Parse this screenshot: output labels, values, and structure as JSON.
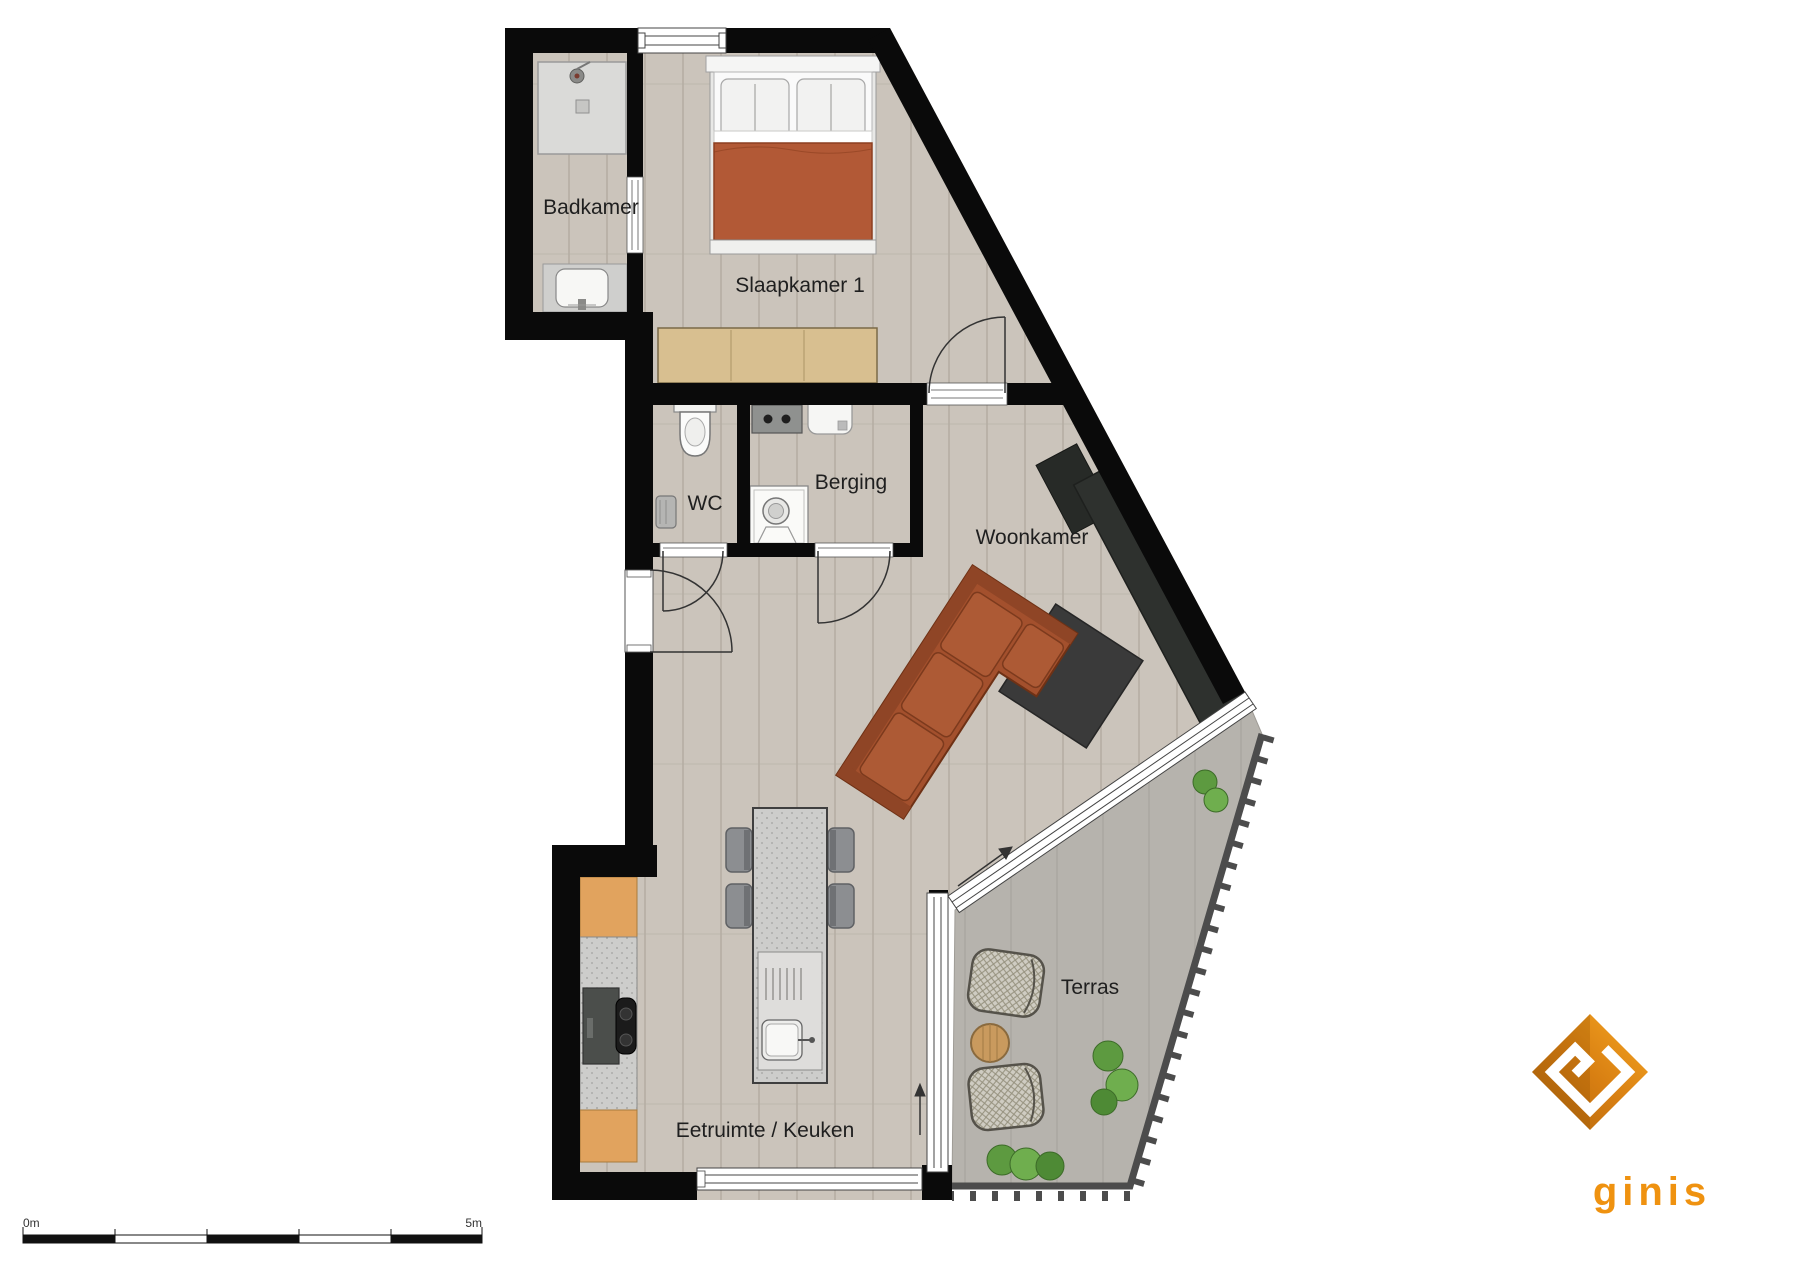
{
  "plan_title": "Apartment floor plan",
  "rooms": {
    "badkamer": "Badkamer",
    "slaapkamer": "Slaapkamer 1",
    "wc": "WC",
    "berging": "Berging",
    "woonkamer": "Woonkamer",
    "eetruimte": "Eetruimte / Keuken",
    "terras": "Terras"
  },
  "scale_bar": {
    "start": "0m",
    "end": "5m"
  },
  "brand": {
    "name": "ginis"
  },
  "colors": {
    "wall": "#0a0a0a",
    "wood_floor": "#cbc4bb",
    "terrace_floor": "#b6b3ad",
    "duvet_orange": "#b25936",
    "sofa_orange": "#a3502d",
    "wardrobe_tan": "#d8bf90",
    "counter_orange": "#e1a35e",
    "brand_orange": "#ef9210",
    "dark_furniture": "#2e312e"
  },
  "icons": [
    "bed-icon",
    "shower-icon",
    "bathroom-sink-icon",
    "toilet-icon",
    "radiator-icon",
    "washing-machine-icon",
    "boiler-icon",
    "storage-counter-icon",
    "sofa-icon",
    "rug-icon",
    "tv-sideboard-icon",
    "kitchen-island-icon",
    "island-sink-icon",
    "dining-chair-icon",
    "kitchen-counter-icon",
    "stove-icon",
    "cooktop-icon",
    "terrace-chair-icon",
    "terrace-table-icon",
    "bush-icon",
    "door-swing-icon",
    "window-icon",
    "sliding-door-icon",
    "ginis-diamond-icon"
  ]
}
